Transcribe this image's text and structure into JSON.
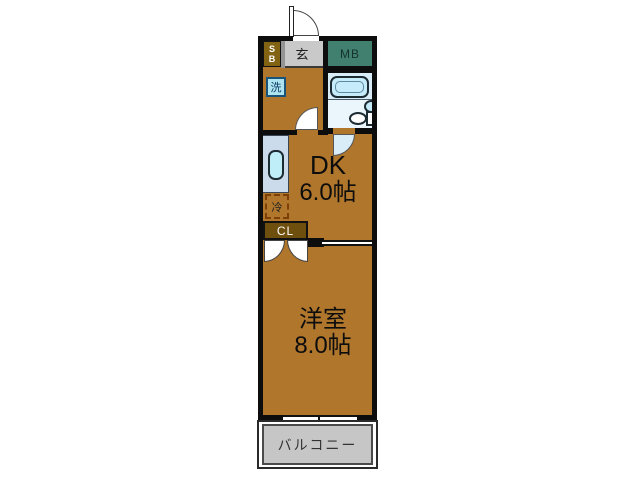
{
  "title": "1DK apartment floor plan",
  "colors": {
    "wall": "#0d0d0d",
    "room_brown": "#b0762c",
    "shoe_box_brown": "#826313",
    "closet_brown": "#6f4f0e",
    "meter_box_teal": "#41806f",
    "entrance_gray": "#c9c9c9",
    "bath_blue": "#d9edf9",
    "tub_blue": "#c6ebfa",
    "kitchen_counter": "#ccdbeb",
    "sink_blue": "#bfeef9",
    "washer_blue": "#aee4f0",
    "fridge_dash": "#7d3f06",
    "balcony_gray": "#c6c6c6"
  },
  "rooms": {
    "shoe_box": {
      "label": "S\nB"
    },
    "entrance": {
      "label": "玄"
    },
    "meter_box": {
      "label": "MB"
    },
    "washer": {
      "label": "洗"
    },
    "dining_kitchen": {
      "name": "DK",
      "size": "6.0帖"
    },
    "refrigerator": {
      "label": "冷"
    },
    "closet": {
      "label": "CL"
    },
    "western_room": {
      "name": "洋室",
      "size": "8.0帖"
    },
    "balcony": {
      "label": "バルコニー"
    }
  }
}
